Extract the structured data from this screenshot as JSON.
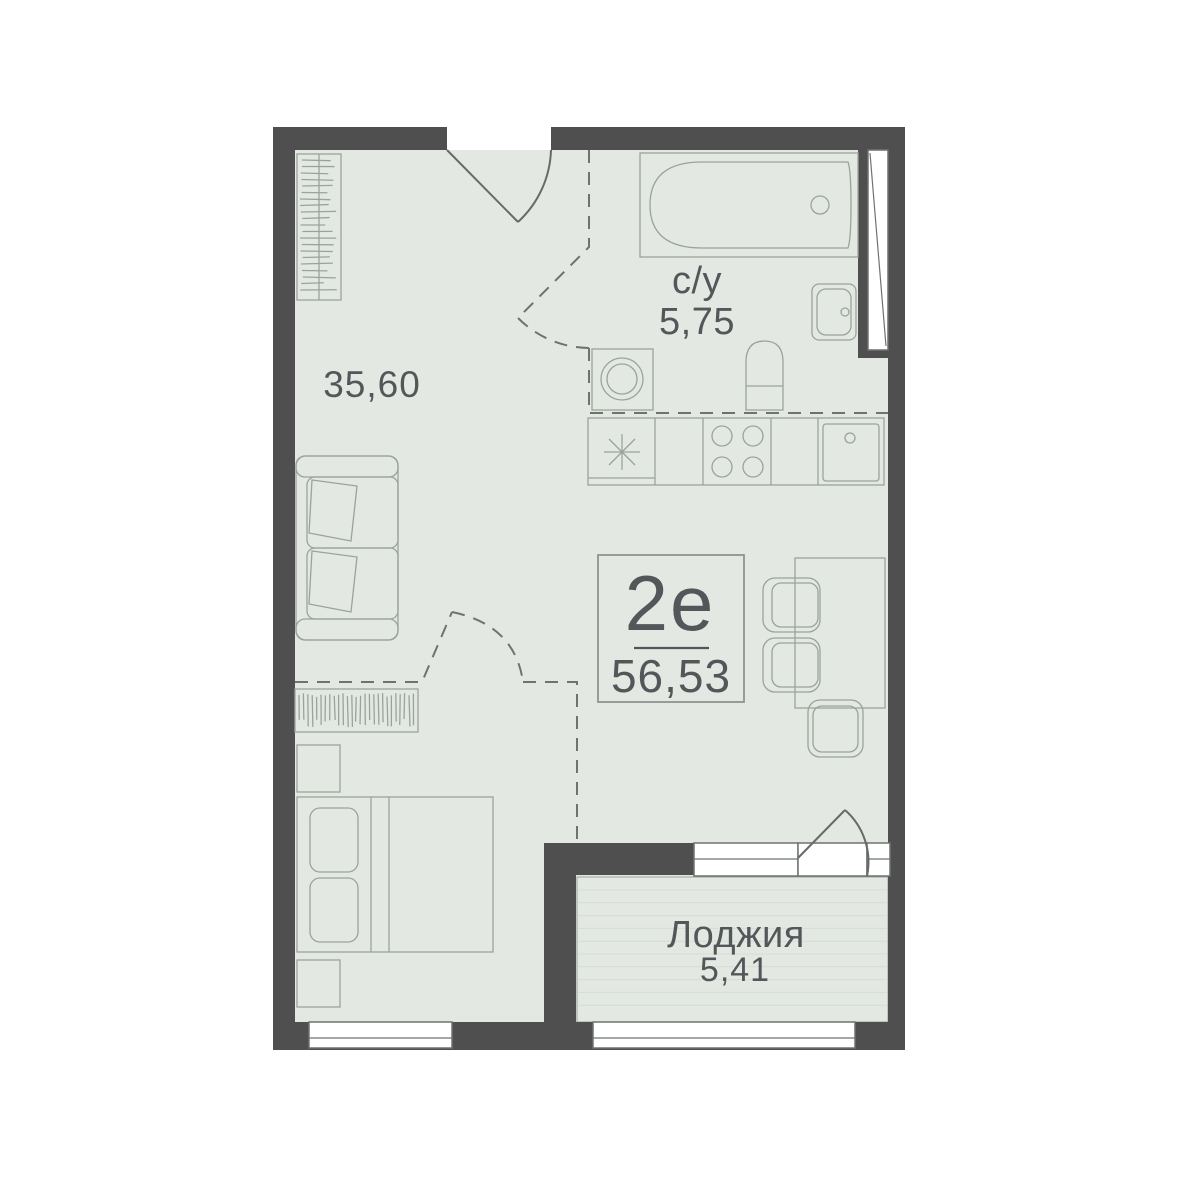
{
  "unit": {
    "type_label": "2е",
    "total_area": "56,53"
  },
  "rooms": {
    "living": {
      "area": "35,60"
    },
    "bathroom": {
      "label": "с/у",
      "area": "5,75"
    },
    "loggia": {
      "label": "Лоджия",
      "area": "5,41"
    }
  },
  "colors": {
    "wall": "#4f4f4f",
    "floor": "#e3e8e3",
    "furniture-line": "#9aa39b",
    "dash-line": "#6e736e",
    "door-line": "#666b66",
    "frame-line": "#6e736e",
    "stripe": "#d4dcd4",
    "text": "#54575a",
    "background": "#ffffff"
  }
}
